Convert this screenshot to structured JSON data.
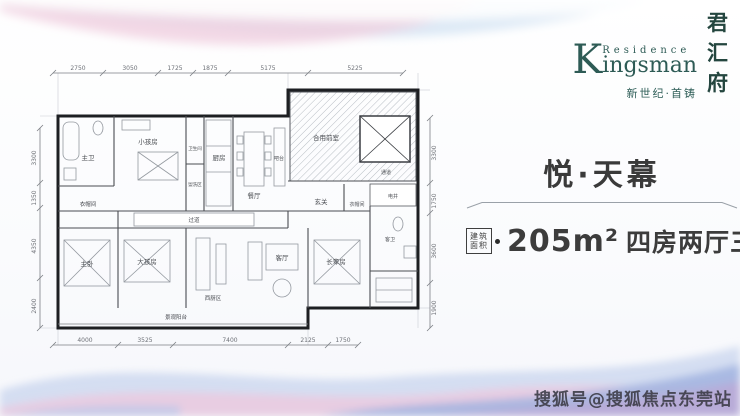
{
  "page": {
    "watermark": "搜狐号@搜狐焦点东莞站"
  },
  "brand": {
    "kanji": [
      "君",
      "汇",
      "府"
    ],
    "k": "K",
    "residence": "Residence",
    "ingsman": "ingsman",
    "tagline": "新世纪·首铸"
  },
  "listing": {
    "title": "悦·天幕",
    "badge": [
      "建筑",
      "面积"
    ],
    "area": "205m²",
    "rooms_text": "四房两厅三卫"
  },
  "floorplan": {
    "dims_top": [
      "2750",
      "3050",
      "1725",
      "1875",
      "5175",
      "5225"
    ],
    "dims_bottom": [
      "4000",
      "3525",
      "7400",
      "2125",
      "1750"
    ],
    "dims_left": [
      "3300",
      "1350",
      "4350",
      "2400"
    ],
    "dims_right": [
      "3300",
      "1750",
      "3600",
      "1900"
    ],
    "rooms": {
      "master_bath": "主卫",
      "kids_room": "小孩房",
      "toilet": "卫生间",
      "wash": "盥洗区",
      "kitchen": "厨房",
      "dining": "餐厅",
      "bar": "吧台",
      "shared_lobby": "合用前室",
      "passage": "通道",
      "shaft": "电井",
      "foyer": "玄关",
      "corridor": "过道",
      "closet_left": "衣帽间",
      "closet_right": "衣帽间",
      "master_bed": "主卧",
      "elder_kid": "大孩房",
      "west_kitchen": "西厨区",
      "living": "客厅",
      "elder_room": "长辈房",
      "guest_bath": "客卫",
      "balcony": "景观阳台"
    }
  }
}
